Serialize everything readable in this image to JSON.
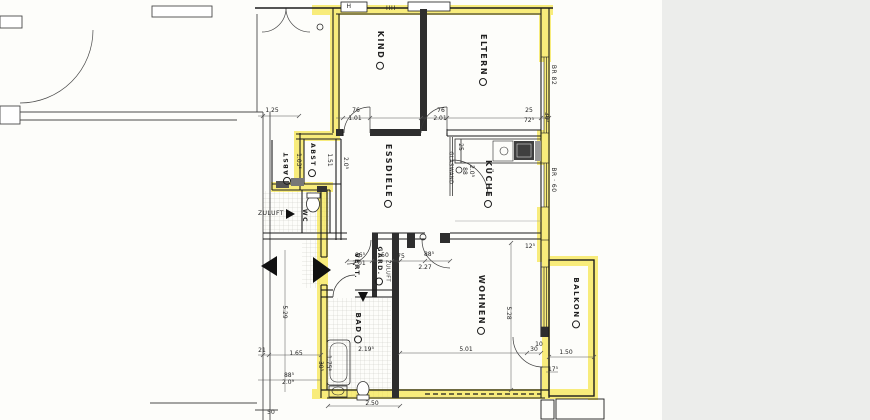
{
  "document": {
    "kind": "architectural floor plan, apartment outlined with yellow highlighter"
  },
  "colors": {
    "highlight": "#f6e22e",
    "wall": "#1c1c1c",
    "paper": "#fdfdfa",
    "margin": "#ecedeb",
    "hatch": "#c9c9c4"
  },
  "rooms": [
    {
      "text": "KIND",
      "x": 380,
      "y": 50,
      "rot": 90,
      "size": 8,
      "badge": true
    },
    {
      "text": "ELTERN",
      "x": 483,
      "y": 60,
      "rot": 90,
      "size": 8,
      "badge": true
    },
    {
      "text": "ESSDIELE",
      "x": 388,
      "y": 176,
      "rot": 90,
      "size": 8,
      "badge": true
    },
    {
      "text": "KÜCHE",
      "x": 488,
      "y": 184,
      "rot": 90,
      "size": 8,
      "badge": true
    },
    {
      "text": "WOHNEN",
      "x": 481,
      "y": 305,
      "rot": 90,
      "size": 8,
      "badge": true
    },
    {
      "text": "BALKON",
      "x": 576,
      "y": 303,
      "rot": 90,
      "size": 7,
      "badge": true
    },
    {
      "text": "BAD",
      "x": 358,
      "y": 328,
      "rot": 90,
      "size": 7,
      "badge": true
    },
    {
      "text": "GARD.",
      "x": 379,
      "y": 266,
      "rot": 90,
      "size": 6,
      "badge": true
    },
    {
      "text": "VERT.",
      "x": 356,
      "y": 266,
      "rot": 90,
      "size": 6,
      "badge": false
    },
    {
      "text": "ABST",
      "x": 312,
      "y": 160,
      "rot": 90,
      "size": 6,
      "badge": true
    },
    {
      "text": "ABST",
      "x": 287,
      "y": 168,
      "rot": -90,
      "size": 6,
      "badge": true,
      "badgePos": "start"
    },
    {
      "text": "WC",
      "x": 304,
      "y": 216,
      "rot": 90,
      "size": 6,
      "badge": false
    }
  ],
  "wall_labels": [
    {
      "text": "GLASWAND",
      "x": 450,
      "y": 168,
      "rot": 90,
      "size": 5
    },
    {
      "text": "ZULUFT",
      "x": 271,
      "y": 214,
      "rot": 0,
      "size": 6
    },
    {
      "text": "ZULUFT",
      "x": 387,
      "y": 271,
      "rot": 90,
      "size": 5
    },
    {
      "text": "BR 82",
      "x": 553,
      "y": 75,
      "rot": 90,
      "size": 6
    },
    {
      "text": "BR · 60",
      "x": 553,
      "y": 180,
      "rot": 90,
      "size": 6
    },
    {
      "text": "H",
      "x": 349,
      "y": 7,
      "rot": 0,
      "size": 6
    },
    {
      "text": "HH",
      "x": 391,
      "y": 9,
      "rot": 0,
      "size": 6
    }
  ],
  "dimensions": [
    {
      "text": "1.25",
      "x": 272,
      "y": 111
    },
    {
      "text": "76",
      "x": 356,
      "y": 111
    },
    {
      "text": "1.01",
      "x": 355,
      "y": 119
    },
    {
      "text": "76",
      "x": 441,
      "y": 111
    },
    {
      "text": "2.01",
      "x": 440,
      "y": 119
    },
    {
      "text": "25",
      "x": 529,
      "y": 111
    },
    {
      "text": "72⁵",
      "x": 529,
      "y": 121
    },
    {
      "text": "36⁵",
      "x": 546,
      "y": 117,
      "rot": 90
    },
    {
      "text": "1.03⁵",
      "x": 298,
      "y": 161,
      "rot": 90
    },
    {
      "text": "1.51",
      "x": 329,
      "y": 160,
      "rot": 90
    },
    {
      "text": "2.0⁵",
      "x": 345,
      "y": 163,
      "rot": 90
    },
    {
      "text": "25",
      "x": 460,
      "y": 147,
      "rot": 90
    },
    {
      "text": "88",
      "x": 464,
      "y": 171,
      "rot": 90
    },
    {
      "text": "2.0⁵",
      "x": 471,
      "y": 171,
      "rot": 90
    },
    {
      "text": "86⁵",
      "x": 360,
      "y": 256
    },
    {
      "text": "2.01",
      "x": 359,
      "y": 264
    },
    {
      "text": "50",
      "x": 385,
      "y": 256
    },
    {
      "text": "75",
      "x": 401,
      "y": 257
    },
    {
      "text": "88⁵",
      "x": 429,
      "y": 255
    },
    {
      "text": "2.27",
      "x": 425,
      "y": 268
    },
    {
      "text": "12⁵",
      "x": 530,
      "y": 247
    },
    {
      "text": "5.28",
      "x": 508,
      "y": 313,
      "rot": 90
    },
    {
      "text": "5.01",
      "x": 466,
      "y": 350
    },
    {
      "text": "30",
      "x": 534,
      "y": 350
    },
    {
      "text": "10",
      "x": 539,
      "y": 345
    },
    {
      "text": "1.50",
      "x": 566,
      "y": 353
    },
    {
      "text": "17⁵",
      "x": 553,
      "y": 370
    },
    {
      "text": "5.29",
      "x": 284,
      "y": 312,
      "rot": 90
    },
    {
      "text": "21",
      "x": 262,
      "y": 351
    },
    {
      "text": "1.65",
      "x": 296,
      "y": 354
    },
    {
      "text": "88⁵",
      "x": 289,
      "y": 376
    },
    {
      "text": "2.0⁹",
      "x": 288,
      "y": 383
    },
    {
      "text": "30⁵",
      "x": 320,
      "y": 366,
      "rot": 90
    },
    {
      "text": "1.75⁵",
      "x": 328,
      "y": 363,
      "rot": 90
    },
    {
      "text": "2.19⁵",
      "x": 366,
      "y": 350
    },
    {
      "text": "2.50",
      "x": 372,
      "y": 404
    },
    {
      "text": "50",
      "x": 271,
      "y": 413
    }
  ]
}
